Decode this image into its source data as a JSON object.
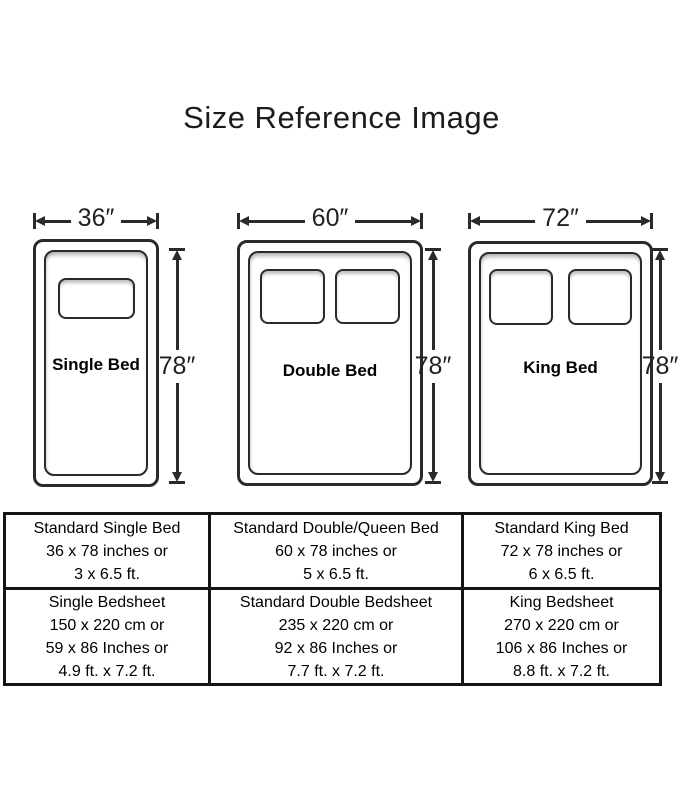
{
  "page": {
    "title": "Size Reference Image"
  },
  "colors": {
    "line": "#2a2a2a",
    "table_border": "#151515",
    "text": "#111111",
    "background": "#ffffff"
  },
  "beds": [
    {
      "name": "Single Bed",
      "width_label": "36″",
      "height_label": "78″",
      "pillow_count": 1
    },
    {
      "name": "Double Bed",
      "width_label": "60″",
      "height_label": "78″",
      "pillow_count": 2
    },
    {
      "name": "King Bed",
      "width_label": "72″",
      "height_label": "78″",
      "pillow_count": 2
    }
  ],
  "size_table": {
    "rows": [
      {
        "cells": [
          {
            "lines": [
              "Standard Single Bed",
              "36 x 78 inches or",
              "3 x 6.5 ft."
            ]
          },
          {
            "lines": [
              "Standard Double/Queen Bed",
              "60 x 78 inches or",
              "5 x 6.5 ft."
            ]
          },
          {
            "lines": [
              "Standard King Bed",
              "72 x 78 inches or",
              "6 x 6.5 ft."
            ]
          }
        ]
      },
      {
        "cells": [
          {
            "lines": [
              "Single Bedsheet",
              "150 x 220 cm or",
              "59 x 86 Inches or",
              "4.9 ft. x 7.2 ft."
            ]
          },
          {
            "lines": [
              "Standard Double Bedsheet",
              "235 x 220 cm or",
              "92 x 86 Inches or",
              "7.7 ft. x 7.2 ft."
            ]
          },
          {
            "lines": [
              "King Bedsheet",
              "270 x 220 cm or",
              "106 x 86 Inches or",
              "8.8 ft. x 7.2 ft."
            ]
          }
        ]
      }
    ]
  }
}
